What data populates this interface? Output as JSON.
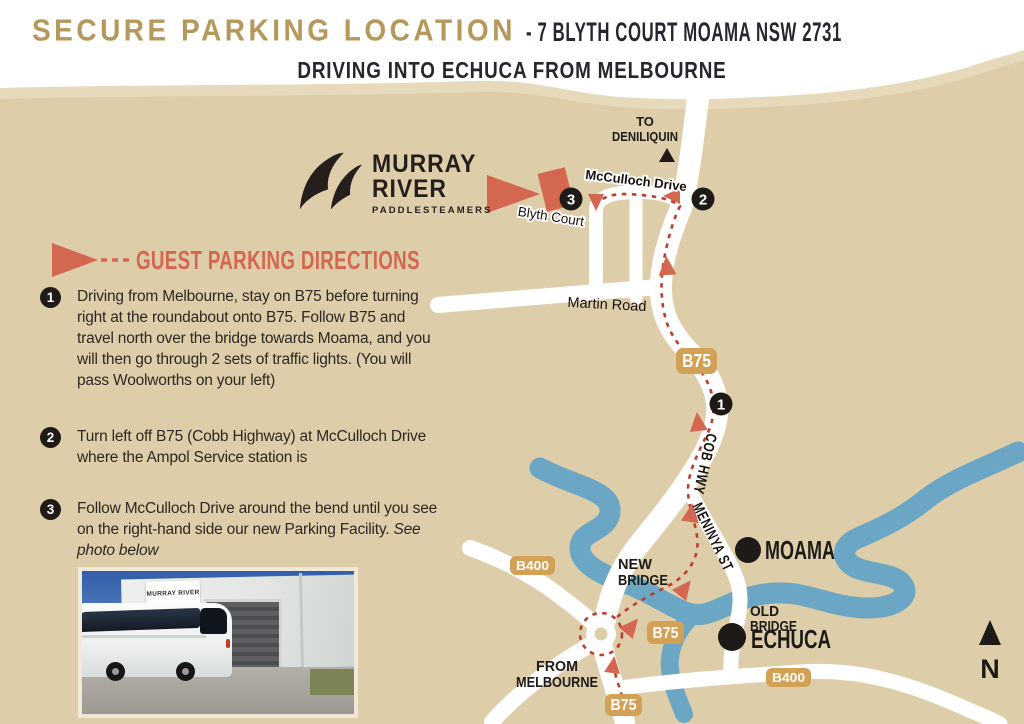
{
  "page": {
    "title_gold": "SECURE PARKING LOCATION",
    "title_sep": "-",
    "title_dark": "7 BLYTH COURT MOAMA NSW 2731",
    "subtitle": "DRIVING INTO ECHUCA FROM MELBOURNE"
  },
  "logo": {
    "line1": "MURRAY",
    "line2": "RIVER",
    "line3": "PADDLESTEAMERS"
  },
  "directions": {
    "heading": "GUEST PARKING DIRECTIONS",
    "steps": [
      {
        "number": "1",
        "text": "Driving from Melbourne, stay on B75 before turning right at the roundabout onto B75. Follow B75 and travel north over the bridge towards Moama, and you will then go through 2 sets of traffic lights. (You will pass Woolworths on your left)"
      },
      {
        "number": "2",
        "text": "Turn left off B75 (Cobb Highway) at McCulloch Drive where the Ampol Service station is"
      },
      {
        "number": "3",
        "text": "Follow McCulloch Drive around the bend until you see on the right-hand side our new Parking Facility. ",
        "italic": "See photo below"
      }
    ]
  },
  "map": {
    "deniliquin_line1": "TO",
    "deniliquin_line2": "DENILIQUIN",
    "streets": {
      "mcculloch": "McCulloch Drive",
      "blyth": "Blyth Court",
      "martin": "Martin Road",
      "cob_hwy": "COB HWY",
      "meninya": "MENINYA ST"
    },
    "bridges": {
      "new_line1": "NEW",
      "new_line2": "BRIDGE",
      "old_line1": "OLD",
      "old_line2": "BRIDGE"
    },
    "towns": {
      "moama": "MOAMA",
      "echuca": "ECHUCA"
    },
    "origin_line1": "FROM",
    "origin_line2": "MELBOURNE",
    "compass": "N",
    "shields": [
      {
        "label": "B75"
      },
      {
        "label": "B75"
      },
      {
        "label": "B75"
      },
      {
        "label": "B400"
      },
      {
        "label": "B400"
      }
    ],
    "markers": [
      {
        "number": "1"
      },
      {
        "number": "2"
      },
      {
        "number": "3"
      }
    ]
  },
  "photo": {
    "sign_text": "MURRAY RIVER"
  },
  "colors": {
    "land": "#ddcda9",
    "land_light": "#e7dabb",
    "river": "#6ba6c4",
    "road": "#ffffff",
    "route_red": "#bc3f2e",
    "accent_coral": "#d4674f",
    "shield_gold": "#d2a155",
    "title_gold": "#b5985a",
    "marker_black": "#1d1a17"
  }
}
